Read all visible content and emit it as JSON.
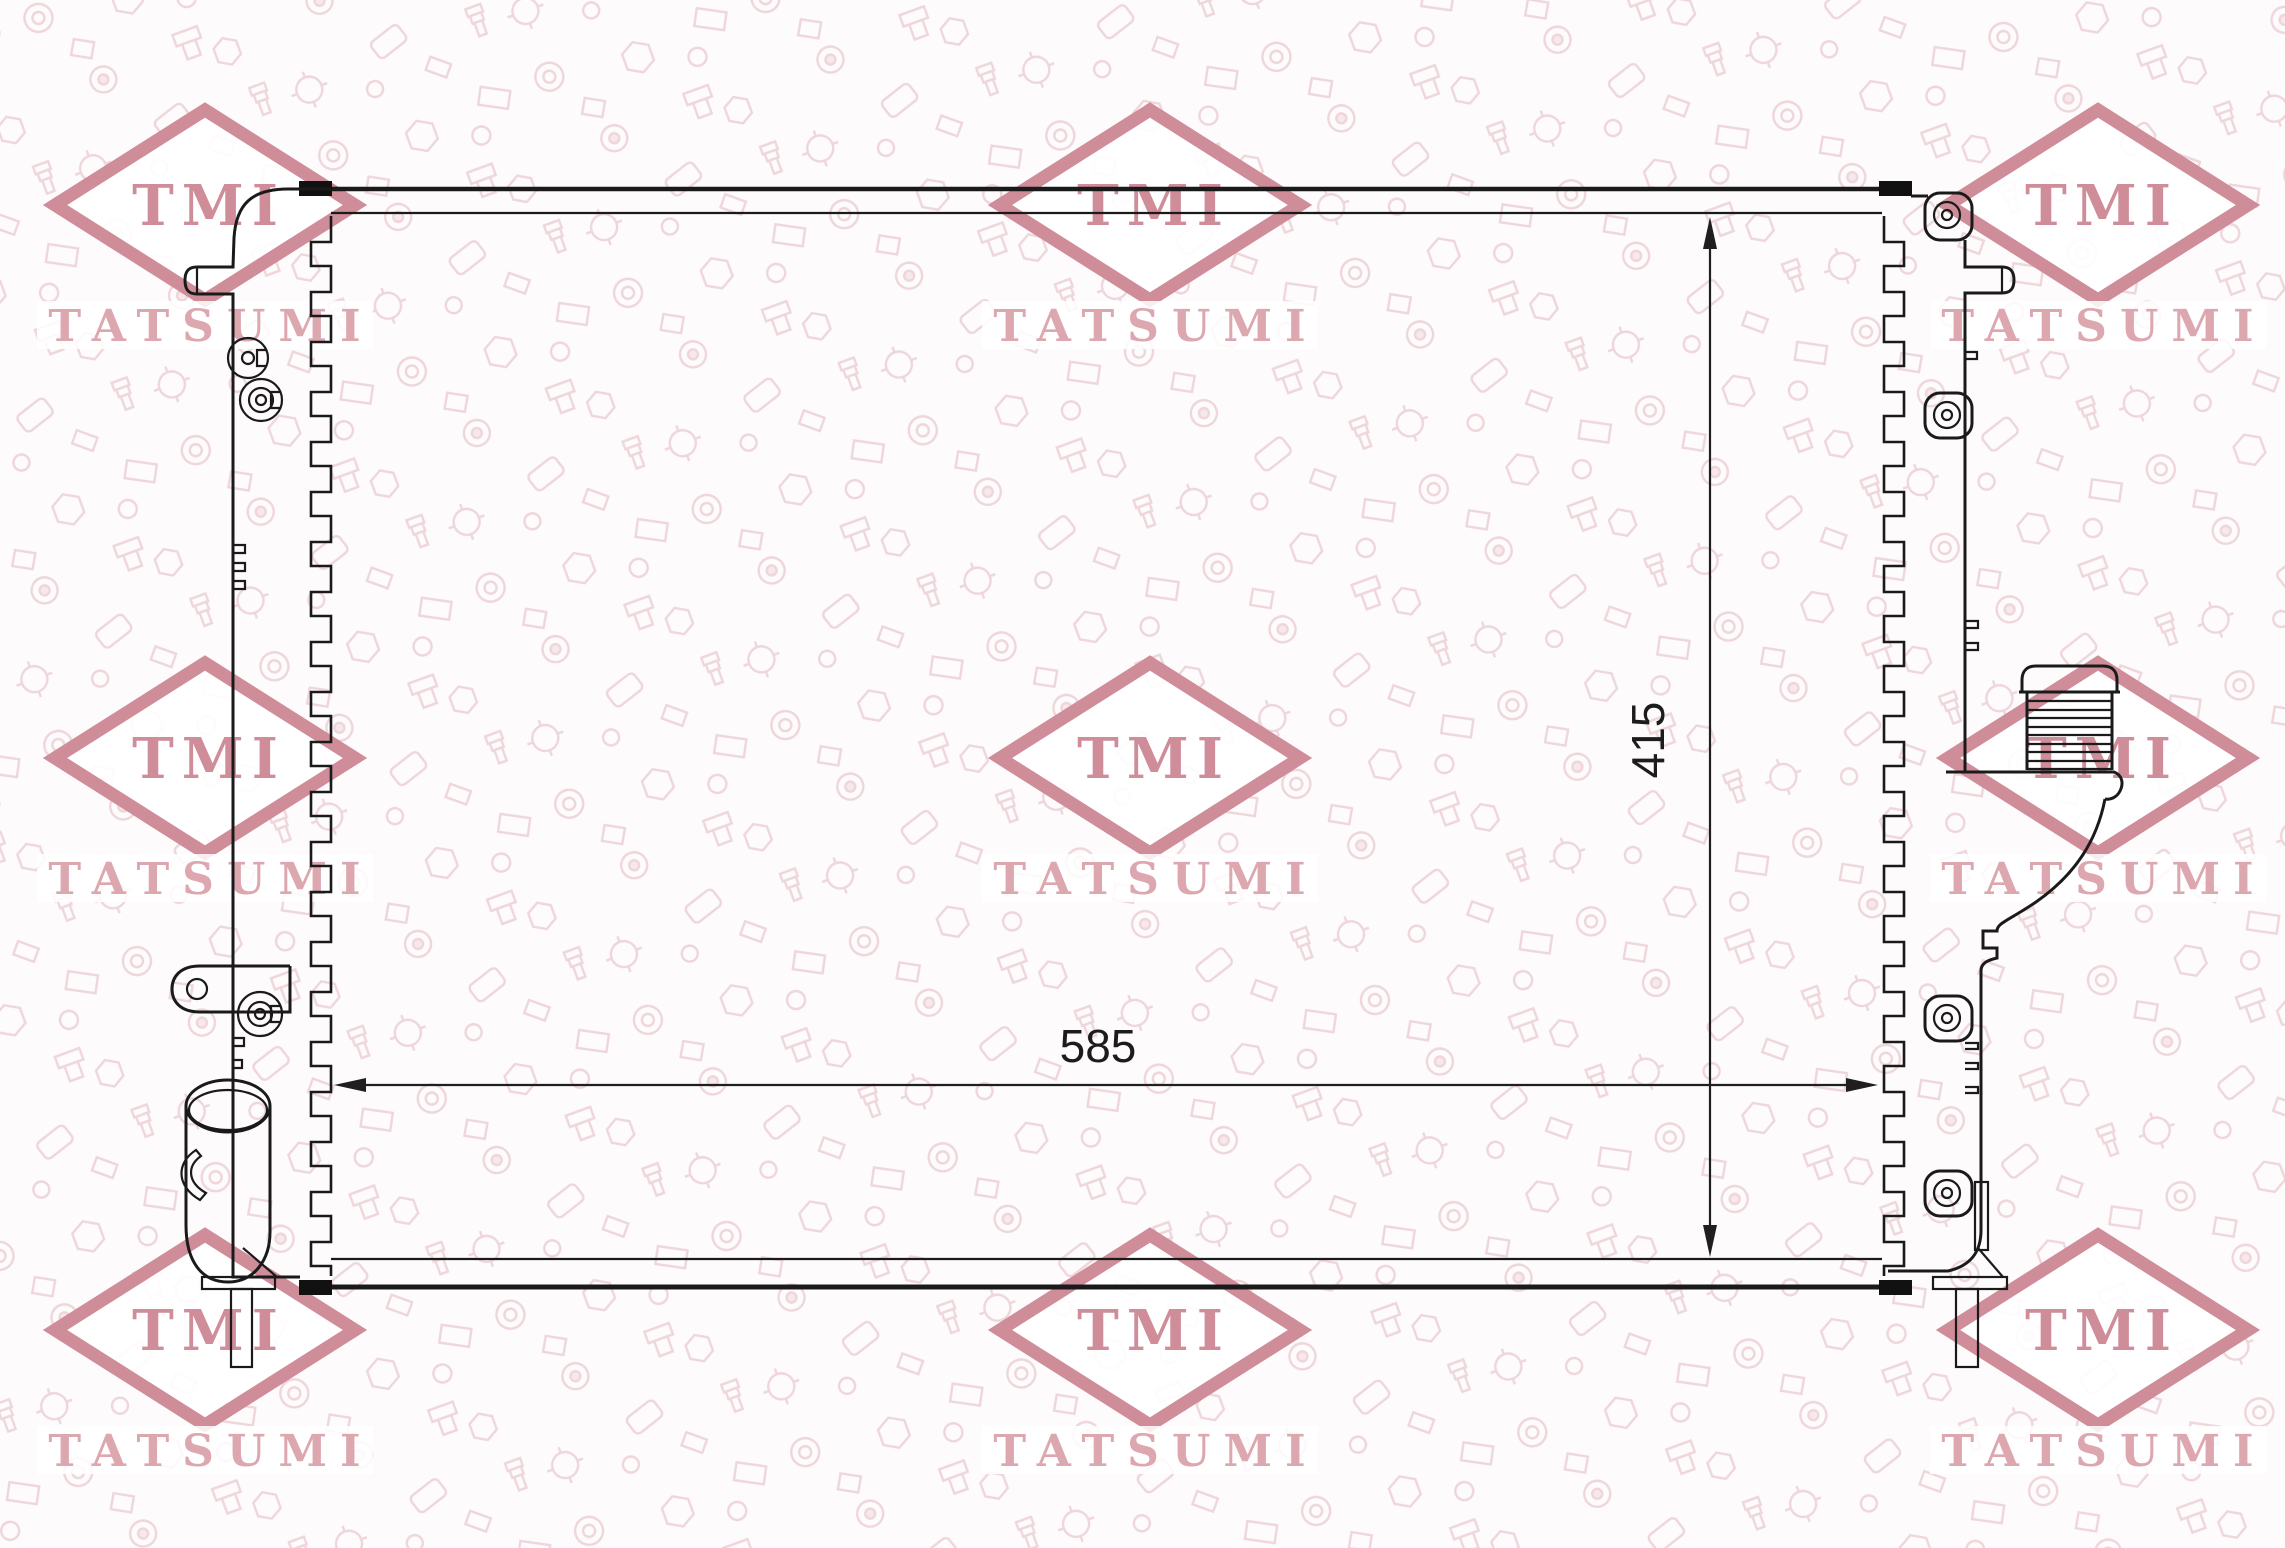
{
  "brand": {
    "logo": "TMI",
    "name": "TATSUMI"
  },
  "dimension_labels": {
    "core_width": "585",
    "core_height": "415"
  },
  "watermark_grid": {
    "columns_x": [
      205,
      1150,
      2098
    ],
    "rows_y": [
      205,
      758,
      1330
    ]
  },
  "colors": {
    "watermark": "#cf8c99",
    "watermark_light": "#dda7b0",
    "pattern": "#eed6db",
    "line": "#1a1a1a",
    "background": "#fdfbfb"
  }
}
